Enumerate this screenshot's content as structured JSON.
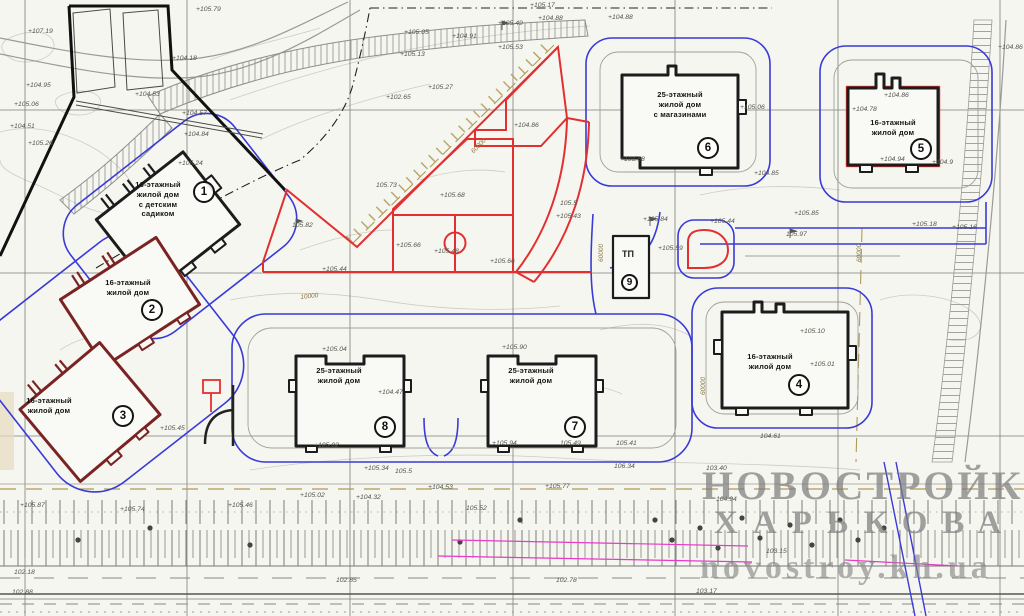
{
  "buildings": [
    {
      "num": "1",
      "label_lines": [
        "16-этажный",
        "жилой дом",
        "с детским",
        "садиком"
      ]
    },
    {
      "num": "2",
      "label_lines": [
        "16-этажный",
        "жилой дом"
      ]
    },
    {
      "num": "3",
      "label_lines": [
        "16-этажный",
        "жилой дом"
      ]
    },
    {
      "num": "4",
      "label_lines": [
        "16-этажный",
        "жилой дом"
      ]
    },
    {
      "num": "5",
      "label_lines": [
        "16-этажный",
        "жилой дом"
      ]
    },
    {
      "num": "6",
      "label_lines": [
        "25-этажный",
        "жилой дом",
        "с магазинами"
      ]
    },
    {
      "num": "7",
      "label_lines": [
        "25-этажный",
        "жилой дом"
      ]
    },
    {
      "num": "8",
      "label_lines": [
        "25-этажный",
        "жилой дом"
      ]
    },
    {
      "num": "9",
      "label": "ТП"
    }
  ],
  "watermark": {
    "line1": "НОВОСТРОЙКИ",
    "line2": "ХАРЬКОВА",
    "line3": "novostroy.kh.ua"
  },
  "colors": {
    "site_red": "#e23030",
    "access_blue": "#3a3ad8",
    "building_dark": "#1c1c1c",
    "building_maroon": "#7a2323",
    "dimension_tan": "#b09a55",
    "utility_magenta": "#e83ac8",
    "watermark_gray": "#8f8f8f"
  },
  "dimensions": [
    {
      "t": "60000",
      "x": 598,
      "y": 262,
      "rot": -90
    },
    {
      "t": "60000",
      "x": 856,
      "y": 262,
      "rot": -90
    },
    {
      "t": "60000",
      "x": 700,
      "y": 395,
      "rot": -90
    },
    {
      "t": "60000",
      "x": 470,
      "y": 150,
      "rot": -45
    },
    {
      "t": "10000",
      "x": 300,
      "y": 294,
      "rot": -6
    }
  ],
  "elevations": [
    {
      "t": "+107.19",
      "x": 28,
      "y": 28
    },
    {
      "t": "+104.18",
      "x": 172,
      "y": 55
    },
    {
      "t": "+105.79",
      "x": 196,
      "y": 6
    },
    {
      "t": "+104.95",
      "x": 26,
      "y": 82
    },
    {
      "t": "+105.06",
      "x": 14,
      "y": 101
    },
    {
      "t": "+104.53",
      "x": 135,
      "y": 91
    },
    {
      "t": "+104.57",
      "x": 182,
      "y": 110
    },
    {
      "t": "+104.84",
      "x": 184,
      "y": 131
    },
    {
      "t": "+104.51",
      "x": 10,
      "y": 123
    },
    {
      "t": "+105.26",
      "x": 28,
      "y": 140
    },
    {
      "t": "+105.24",
      "x": 178,
      "y": 160
    },
    {
      "t": "+105.17",
      "x": 530,
      "y": 2
    },
    {
      "t": "+104.88",
      "x": 538,
      "y": 15
    },
    {
      "t": "+105.49",
      "x": 498,
      "y": 20
    },
    {
      "t": "+105.05",
      "x": 404,
      "y": 29
    },
    {
      "t": "+104.91",
      "x": 452,
      "y": 33
    },
    {
      "t": "+105.13",
      "x": 400,
      "y": 51
    },
    {
      "t": "+105.53",
      "x": 498,
      "y": 44
    },
    {
      "t": "+105.27",
      "x": 428,
      "y": 84
    },
    {
      "t": "+102.65",
      "x": 386,
      "y": 94
    },
    {
      "t": "+104.88",
      "x": 608,
      "y": 14
    },
    {
      "t": "105.73",
      "x": 376,
      "y": 182
    },
    {
      "t": "105.82",
      "x": 292,
      "y": 222
    },
    {
      "t": "+105.68",
      "x": 440,
      "y": 192
    },
    {
      "t": "+105.66",
      "x": 396,
      "y": 242
    },
    {
      "t": "+105.48",
      "x": 434,
      "y": 248
    },
    {
      "t": "+105.66",
      "x": 490,
      "y": 258
    },
    {
      "t": "+105.44",
      "x": 322,
      "y": 266
    },
    {
      "t": "+104.86",
      "x": 514,
      "y": 122
    },
    {
      "t": "105.5",
      "x": 560,
      "y": 200
    },
    {
      "t": "+105.43",
      "x": 556,
      "y": 213
    },
    {
      "t": "+104.86",
      "x": 998,
      "y": 44
    },
    {
      "t": "+104.86",
      "x": 884,
      "y": 92
    },
    {
      "t": "+104.78",
      "x": 852,
      "y": 106
    },
    {
      "t": "+104.94",
      "x": 880,
      "y": 156
    },
    {
      "t": "+104.9",
      "x": 932,
      "y": 159
    },
    {
      "t": "+105.06",
      "x": 740,
      "y": 104
    },
    {
      "t": "+103.68",
      "x": 620,
      "y": 156
    },
    {
      "t": "+105.85",
      "x": 794,
      "y": 210
    },
    {
      "t": "+104.85",
      "x": 754,
      "y": 170
    },
    {
      "t": "+105.18",
      "x": 912,
      "y": 221
    },
    {
      "t": "+105.16",
      "x": 952,
      "y": 224
    },
    {
      "t": "+105.84",
      "x": 643,
      "y": 216
    },
    {
      "t": "+105.59",
      "x": 658,
      "y": 245
    },
    {
      "t": "+105.44",
      "x": 710,
      "y": 218
    },
    {
      "t": "105.97",
      "x": 786,
      "y": 231
    },
    {
      "t": "+105.10",
      "x": 800,
      "y": 328
    },
    {
      "t": "+105.01",
      "x": 810,
      "y": 361
    },
    {
      "t": "104.61",
      "x": 760,
      "y": 433
    },
    {
      "t": "+105.04",
      "x": 322,
      "y": 346
    },
    {
      "t": "+104.47",
      "x": 378,
      "y": 389
    },
    {
      "t": "+105.02",
      "x": 314,
      "y": 442
    },
    {
      "t": "+105.90",
      "x": 502,
      "y": 344
    },
    {
      "t": "+105.94",
      "x": 492,
      "y": 440
    },
    {
      "t": "105.49",
      "x": 560,
      "y": 440
    },
    {
      "t": "105.41",
      "x": 616,
      "y": 440
    },
    {
      "t": "+105.87",
      "x": 20,
      "y": 502
    },
    {
      "t": "+105.74",
      "x": 120,
      "y": 506
    },
    {
      "t": "+105.46",
      "x": 228,
      "y": 502
    },
    {
      "t": "+105.45",
      "x": 160,
      "y": 425
    },
    {
      "t": "+105.02",
      "x": 300,
      "y": 492
    },
    {
      "t": "+104.32",
      "x": 356,
      "y": 494
    },
    {
      "t": "+105.34",
      "x": 364,
      "y": 465
    },
    {
      "t": "105.5",
      "x": 395,
      "y": 468
    },
    {
      "t": "+104.53",
      "x": 428,
      "y": 484
    },
    {
      "t": "106.34",
      "x": 614,
      "y": 463
    },
    {
      "t": "+105.77",
      "x": 545,
      "y": 483
    },
    {
      "t": "105.52",
      "x": 466,
      "y": 505
    },
    {
      "t": "103.15",
      "x": 766,
      "y": 548
    },
    {
      "t": "104.94",
      "x": 716,
      "y": 496
    },
    {
      "t": "103.40",
      "x": 706,
      "y": 465
    },
    {
      "t": "102.78",
      "x": 556,
      "y": 577
    },
    {
      "t": "102.85",
      "x": 336,
      "y": 577
    },
    {
      "t": "103.17",
      "x": 696,
      "y": 588
    },
    {
      "t": "102.18",
      "x": 14,
      "y": 569
    },
    {
      "t": "102.88",
      "x": 12,
      "y": 589
    }
  ]
}
